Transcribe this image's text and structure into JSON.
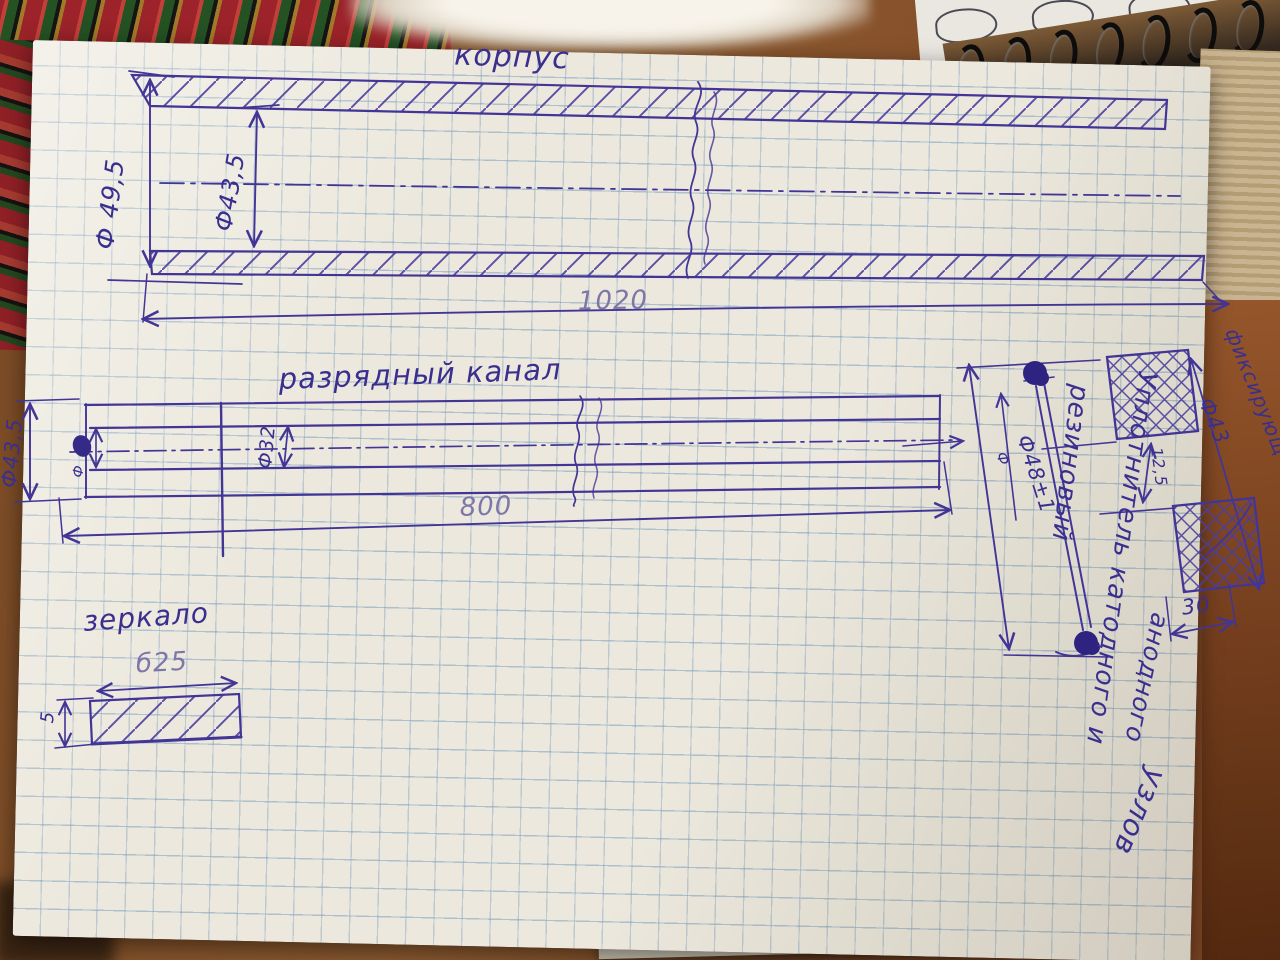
{
  "photo": {
    "description": "Фото рукописного эскиза на листе в клетку"
  },
  "colors": {
    "ink": "#423596",
    "faded_ink": "#7d76a8",
    "paper": "#ece8dd",
    "grid": "#7a9ebe",
    "table_wood": "#7a4a25"
  },
  "sketch": {
    "korpus": {
      "title": "корпус",
      "outer_diameter": "Ф 49,5",
      "inner_diameter": "Ф43,5",
      "length": "1020"
    },
    "channel": {
      "title": "разрядный канал",
      "outer_diameter": "Ф43,5",
      "phi_mark": "Ф",
      "bore_diameter": "Ф32",
      "length": "800"
    },
    "mirror": {
      "title": "зеркало",
      "width": "б25",
      "thickness": "5"
    },
    "seal": {
      "ring_diameter": "Ф48±1",
      "phi_mark": "Ф",
      "gap": "12,5",
      "outer_diameter": "Ф43",
      "width": "30",
      "fixing": "фиксирующ",
      "notes": [
        "резиновый",
        "Уплотнитель катодного и",
        "анодного",
        "узлов"
      ]
    }
  }
}
